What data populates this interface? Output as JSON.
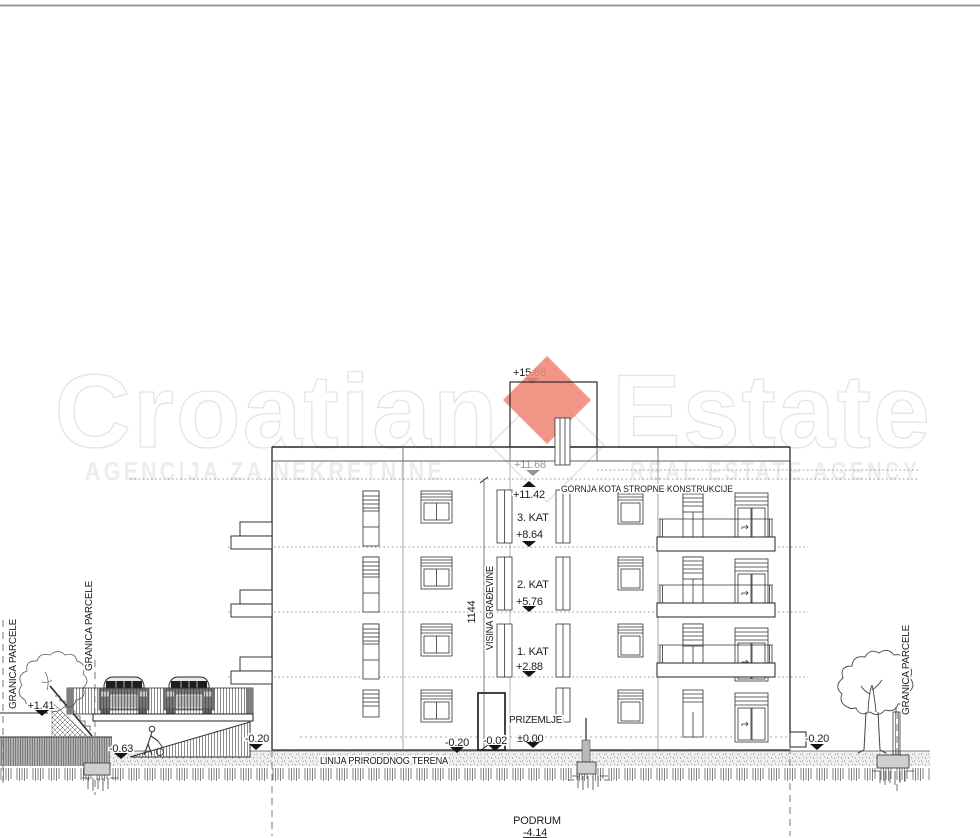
{
  "watermark": {
    "brand_left": "Croatian",
    "brand_right": "Estate",
    "tagline_left": "AGENCIJA ZA NEKRETNINE",
    "tagline_right": "REAL ESTATE AGENCY",
    "logo_color": "#ef8a7a"
  },
  "levels": {
    "roof_top": "+15.68",
    "attic_slab": "+11.68",
    "top_slab": "+11.42",
    "top_slab_note": "GORNJA KOTA STROPNE KONSTRUKCIJE",
    "floor3_name": "3. KAT",
    "floor3_elev": "+8.64",
    "floor2_name": "2. KAT",
    "floor2_elev": "+5.76",
    "floor1_name": "1. KAT",
    "floor1_elev": "+2.88",
    "ground_name": "PRIZEMLJE",
    "ground_elev": "±0.00",
    "basement_name": "PODRUM",
    "basement_elev": "-4.14"
  },
  "site": {
    "left_wall_top": "+1.41",
    "ramp_low": "-0.63",
    "left_terrain": "-0.20",
    "entry_terrain": "-0.20",
    "entry_step": "-0.02",
    "entry_zero": "±0.00",
    "right_terrain": "-0.20"
  },
  "dimension": {
    "value": "1144",
    "label": "VISINA GRAĐEVINE"
  },
  "labels": {
    "terrain_line": "LINIJA PRIRODDNOG TERENA",
    "parcel_left_outer": "GRANICA PARCELE",
    "parcel_left_inner": "GRANICA PARCELE",
    "parcel_right": "GRANICA PARCELE"
  }
}
